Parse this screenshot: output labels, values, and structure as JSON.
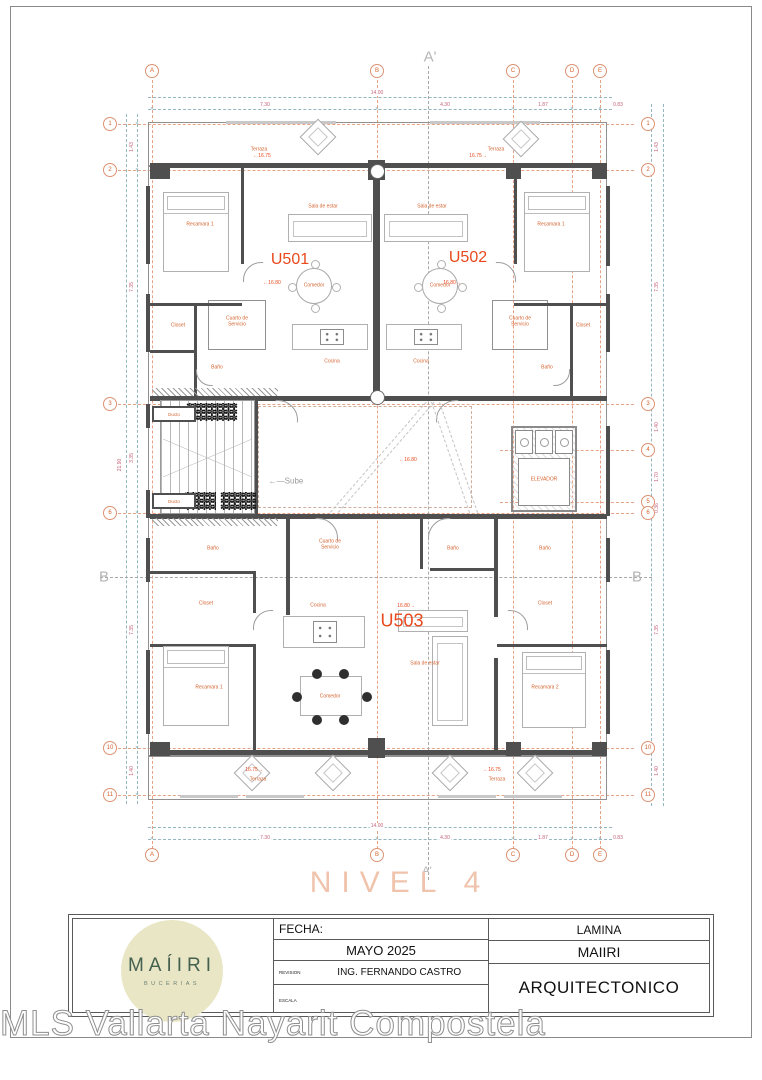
{
  "sheet": {
    "level_title": "NIVEL 4",
    "watermark": "MLS Vallarta Nayarit Compostela"
  },
  "title_block": {
    "logo_name": "MAÍIRI",
    "logo_subtitle": "BUCERIAS",
    "fecha_label": "FECHA:",
    "fecha_value": "MAYO 2025",
    "revision_label": "REVISION",
    "revision_value": "ING. FERNANDO CASTRO",
    "escala_label": "ESCALA",
    "lamina_label": "LAMINA",
    "project_name": "MAIIRI",
    "sheet_name": "ARQUITECTONICO"
  },
  "plan": {
    "grid_cols": [
      {
        "label": "A",
        "x": 152
      },
      {
        "label": "B",
        "x": 377
      },
      {
        "label": "C",
        "x": 513
      },
      {
        "label": "D",
        "x": 572
      },
      {
        "label": "E",
        "x": 600
      }
    ],
    "grid_rows": [
      {
        "label": "1",
        "y": 124,
        "side": "both"
      },
      {
        "label": "2",
        "y": 170,
        "side": "both"
      },
      {
        "label": "3",
        "y": 404,
        "side": "both"
      },
      {
        "label": "4",
        "y": 450,
        "side": "right"
      },
      {
        "label": "5",
        "y": 502,
        "side": "right"
      },
      {
        "label": "6",
        "y": 513,
        "side": "both"
      },
      {
        "label": "10",
        "y": 748,
        "side": "both"
      },
      {
        "label": "11",
        "y": 795,
        "side": "both"
      }
    ],
    "sections": [
      {
        "t": "A'",
        "x": 430,
        "y": 57,
        "s": 15
      },
      {
        "t": "A'",
        "x": 427,
        "y": 871,
        "s": 11
      },
      {
        "t": "B",
        "x": 104,
        "y": 577,
        "s": 15
      },
      {
        "t": "B",
        "x": 637,
        "y": 577,
        "s": 15
      }
    ],
    "slines": [
      {
        "x": 428,
        "y": 66,
        "len": 814,
        "v": 1
      },
      {
        "x": 100,
        "y": 577,
        "len": 552,
        "v": 0
      }
    ],
    "dlines": [
      {
        "x": 148,
        "y": 97,
        "len": 464,
        "v": 0
      },
      {
        "x": 148,
        "y": 109,
        "len": 464,
        "v": 0
      },
      {
        "x": 148,
        "y": 827,
        "len": 464,
        "v": 0
      },
      {
        "x": 148,
        "y": 839,
        "len": 464,
        "v": 0
      },
      {
        "x": 126,
        "y": 114,
        "len": 690,
        "v": 1
      },
      {
        "x": 137,
        "y": 114,
        "len": 690,
        "v": 1
      },
      {
        "x": 651,
        "y": 104,
        "len": 702,
        "v": 1
      },
      {
        "x": 663,
        "y": 104,
        "len": 702,
        "v": 1
      }
    ],
    "dims": [
      {
        "t": "14.00",
        "x": 377,
        "y": 93
      },
      {
        "t": "7.30",
        "x": 265,
        "y": 105
      },
      {
        "t": "4.30",
        "x": 445,
        "y": 105
      },
      {
        "t": "1.87",
        "x": 543,
        "y": 105
      },
      {
        "t": "0.83",
        "x": 618,
        "y": 105
      },
      {
        "t": "14.00",
        "x": 377,
        "y": 826
      },
      {
        "t": "7.30",
        "x": 265,
        "y": 838
      },
      {
        "t": "4.30",
        "x": 445,
        "y": 838
      },
      {
        "t": "1.87",
        "x": 543,
        "y": 838
      },
      {
        "t": "0.83",
        "x": 618,
        "y": 838
      },
      {
        "t": "1.43",
        "x": 132,
        "y": 147,
        "v": 1
      },
      {
        "t": "7.35",
        "x": 132,
        "y": 287,
        "v": 1
      },
      {
        "t": "3.35",
        "x": 132,
        "y": 458,
        "v": 1
      },
      {
        "t": "21.90",
        "x": 120,
        "y": 465,
        "v": 1
      },
      {
        "t": "7.35",
        "x": 132,
        "y": 630,
        "v": 1
      },
      {
        "t": "1.40",
        "x": 132,
        "y": 771,
        "v": 1
      },
      {
        "t": "1.43",
        "x": 657,
        "y": 147,
        "v": 1
      },
      {
        "t": "7.35",
        "x": 657,
        "y": 287,
        "v": 1
      },
      {
        "t": "1.40",
        "x": 657,
        "y": 427,
        "v": 1
      },
      {
        "t": "1.70",
        "x": 657,
        "y": 477,
        "v": 1
      },
      {
        "t": "0.36",
        "x": 657,
        "y": 508,
        "v": 1
      },
      {
        "t": "7.35",
        "x": 657,
        "y": 630,
        "v": 1
      },
      {
        "t": "1.40",
        "x": 657,
        "y": 771,
        "v": 1
      }
    ],
    "walls": [
      [
        150,
        163,
        456,
        5
      ],
      [
        150,
        396,
        457,
        5
      ],
      [
        150,
        514,
        457,
        5
      ],
      [
        150,
        750,
        456,
        5
      ],
      [
        373,
        166,
        7,
        232
      ],
      [
        146,
        186,
        4,
        78
      ],
      [
        146,
        294,
        4,
        58
      ],
      [
        146,
        404,
        4,
        24
      ],
      [
        146,
        490,
        4,
        28
      ],
      [
        146,
        538,
        4,
        44
      ],
      [
        146,
        650,
        4,
        84
      ],
      [
        606,
        186,
        4,
        80
      ],
      [
        606,
        294,
        4,
        58
      ],
      [
        606,
        426,
        4,
        90
      ],
      [
        606,
        538,
        4,
        44
      ],
      [
        606,
        650,
        4,
        84
      ],
      [
        241,
        166,
        3,
        98
      ],
      [
        514,
        166,
        3,
        98
      ],
      [
        150,
        303,
        92,
        3
      ],
      [
        194,
        306,
        3,
        90
      ],
      [
        150,
        350,
        46,
        3
      ],
      [
        514,
        303,
        92,
        3
      ],
      [
        570,
        306,
        3,
        90
      ],
      [
        255,
        398,
        3,
        118
      ],
      [
        286,
        517,
        4,
        98
      ],
      [
        420,
        517,
        3,
        52
      ],
      [
        430,
        568,
        68,
        3
      ],
      [
        494,
        517,
        4,
        100
      ],
      [
        494,
        658,
        4,
        94
      ],
      [
        150,
        571,
        106,
        3
      ],
      [
        150,
        644,
        106,
        3
      ],
      [
        253,
        571,
        3,
        42
      ],
      [
        253,
        646,
        3,
        106
      ],
      [
        497,
        644,
        110,
        3
      ]
    ],
    "boxes": [
      [
        148,
        122,
        459,
        44
      ],
      [
        148,
        166,
        459,
        590
      ],
      [
        148,
        756,
        459,
        44
      ],
      [
        208,
        300,
        58,
        50
      ],
      [
        492,
        300,
        56,
        50
      ]
    ],
    "dashboxes": [
      [
        258,
        406,
        214,
        102
      ]
    ],
    "windows": [
      [
        180,
        795,
        58,
        3
      ],
      [
        246,
        795,
        58,
        3
      ],
      [
        438,
        795,
        58,
        3
      ],
      [
        504,
        795,
        58,
        3
      ],
      [
        226,
        121,
        110,
        3
      ],
      [
        430,
        121,
        110,
        3
      ]
    ],
    "colsq": [
      [
        150,
        163,
        20,
        16
      ],
      [
        368,
        160,
        17,
        20
      ],
      [
        506,
        163,
        15,
        16
      ],
      [
        592,
        163,
        15,
        16
      ],
      [
        150,
        742,
        20,
        14
      ],
      [
        368,
        738,
        17,
        20
      ],
      [
        506,
        742,
        15,
        14
      ],
      [
        592,
        742,
        15,
        14
      ]
    ],
    "colcirc": [
      [
        370,
        164,
        15,
        15
      ],
      [
        370,
        390,
        15,
        15
      ]
    ],
    "furniture": [
      {
        "t": "bed",
        "x": 163,
        "y": 192,
        "w": 66,
        "h": 80
      },
      {
        "t": "bed",
        "x": 524,
        "y": 192,
        "w": 66,
        "h": 80
      },
      {
        "t": "bed",
        "x": 163,
        "y": 646,
        "w": 66,
        "h": 80
      },
      {
        "t": "bed",
        "x": 522,
        "y": 652,
        "w": 64,
        "h": 76
      },
      {
        "t": "sofa",
        "x": 288,
        "y": 214,
        "w": 84,
        "h": 28
      },
      {
        "t": "sofa",
        "x": 384,
        "y": 214,
        "w": 84,
        "h": 28
      },
      {
        "t": "sofa",
        "x": 432,
        "y": 636,
        "w": 36,
        "h": 90
      },
      {
        "t": "sofa",
        "x": 398,
        "y": 610,
        "w": 70,
        "h": 22
      },
      {
        "t": "round",
        "x": 296,
        "y": 268,
        "w": 36,
        "h": 36
      },
      {
        "t": "round",
        "x": 422,
        "y": 268,
        "w": 36,
        "h": 36
      },
      {
        "t": "rtable",
        "x": 300,
        "y": 676,
        "w": 62,
        "h": 40
      },
      {
        "t": "counter",
        "x": 292,
        "y": 324,
        "w": 76,
        "h": 26
      },
      {
        "t": "counter",
        "x": 386,
        "y": 324,
        "w": 76,
        "h": 26
      },
      {
        "t": "counter",
        "x": 283,
        "y": 616,
        "w": 82,
        "h": 32
      },
      {
        "t": "dia",
        "x": 305,
        "y": 124,
        "w": 26,
        "h": 26
      },
      {
        "t": "dia",
        "x": 508,
        "y": 126,
        "w": 26,
        "h": 26
      },
      {
        "t": "dia",
        "x": 239,
        "y": 760,
        "w": 26,
        "h": 26
      },
      {
        "t": "dia",
        "x": 320,
        "y": 760,
        "w": 26,
        "h": 26
      },
      {
        "t": "dia",
        "x": 437,
        "y": 760,
        "w": 26,
        "h": 26
      },
      {
        "t": "dia",
        "x": 522,
        "y": 760,
        "w": 26,
        "h": 26
      },
      {
        "t": "elevator",
        "x": 511,
        "y": 426,
        "w": 66,
        "h": 86
      },
      {
        "t": "stairs",
        "x": 160,
        "y": 400,
        "w": 95,
        "h": 114
      },
      {
        "t": "plant",
        "x": 186,
        "y": 403,
        "w": 66,
        "h": 20
      },
      {
        "t": "plant",
        "x": 184,
        "y": 492,
        "w": 32,
        "h": 20
      },
      {
        "t": "plant",
        "x": 220,
        "y": 492,
        "w": 36,
        "h": 20
      },
      {
        "t": "hatch",
        "x": 152,
        "y": 388,
        "w": 126,
        "h": 8
      },
      {
        "t": "hatch",
        "x": 152,
        "y": 518,
        "w": 126,
        "h": 8
      },
      {
        "t": "ducto",
        "x": 152,
        "y": 406,
        "w": 44,
        "h": 16
      },
      {
        "t": "ducto",
        "x": 152,
        "y": 493,
        "w": 44,
        "h": 16
      }
    ],
    "arcs": [
      {
        "x": 243,
        "y": 262,
        "s": 36,
        "r": 0
      },
      {
        "x": 480,
        "y": 262,
        "s": 36,
        "r": 90
      },
      {
        "x": 196,
        "y": 356,
        "s": 30,
        "r": 270
      },
      {
        "x": 540,
        "y": 356,
        "s": 30,
        "r": 180
      },
      {
        "x": 258,
        "y": 400,
        "s": 40,
        "r": 90
      },
      {
        "x": 436,
        "y": 400,
        "s": 40,
        "r": 0
      },
      {
        "x": 298,
        "y": 518,
        "s": 40,
        "r": 90
      },
      {
        "x": 428,
        "y": 518,
        "s": 40,
        "r": 0
      },
      {
        "x": 253,
        "y": 610,
        "s": 36,
        "r": 0
      },
      {
        "x": 492,
        "y": 610,
        "s": 36,
        "r": 90
      }
    ],
    "rlines": [
      {
        "x": 330,
        "y": 512,
        "len": 146,
        "ang": -49
      },
      {
        "x": 338,
        "y": 512,
        "len": 146,
        "ang": -49
      },
      {
        "x": 432,
        "y": 402,
        "len": 117,
        "ang": 71
      },
      {
        "x": 440,
        "y": 402,
        "len": 117,
        "ang": 71
      }
    ],
    "ducto_label": "Ducto",
    "room_labels": [
      {
        "t": "Terraza",
        "x": 259,
        "y": 150
      },
      {
        "t": "Terraza",
        "x": 496,
        "y": 150
      },
      {
        "t": "Recamara 1",
        "x": 200,
        "y": 225
      },
      {
        "t": "Recamara 1",
        "x": 551,
        "y": 225
      },
      {
        "t": "Sala de estar",
        "x": 323,
        "y": 207
      },
      {
        "t": "Sala de estar",
        "x": 432,
        "y": 207
      },
      {
        "t": "Comedor",
        "x": 314,
        "y": 286
      },
      {
        "t": "Comedor",
        "x": 440,
        "y": 286
      },
      {
        "t": "Cocina",
        "x": 332,
        "y": 362
      },
      {
        "t": "Cocina",
        "x": 421,
        "y": 362
      },
      {
        "t": "Closet",
        "x": 178,
        "y": 326
      },
      {
        "t": "Closet",
        "x": 583,
        "y": 326
      },
      {
        "t": "Cuarto de\nServicio",
        "x": 237,
        "y": 322
      },
      {
        "t": "Cuarto de\nServicio",
        "x": 520,
        "y": 322
      },
      {
        "t": "Baño",
        "x": 217,
        "y": 368
      },
      {
        "t": "Baño",
        "x": 547,
        "y": 368
      },
      {
        "t": "ELEVADOR",
        "x": 544,
        "y": 480
      },
      {
        "t": "Baño",
        "x": 213,
        "y": 549
      },
      {
        "t": "Cuarto de\nServicio",
        "x": 330,
        "y": 545
      },
      {
        "t": "Baño",
        "x": 453,
        "y": 549
      },
      {
        "t": "Baño",
        "x": 545,
        "y": 549
      },
      {
        "t": "Closet",
        "x": 206,
        "y": 604
      },
      {
        "t": "Closet",
        "x": 545,
        "y": 604
      },
      {
        "t": "Cocina",
        "x": 318,
        "y": 606
      },
      {
        "t": "Sala de estar",
        "x": 425,
        "y": 664
      },
      {
        "t": "Comedor",
        "x": 330,
        "y": 697
      },
      {
        "t": "Recamara 1",
        "x": 209,
        "y": 688
      },
      {
        "t": "Recamara 2",
        "x": 545,
        "y": 688
      },
      {
        "t": "Terraza",
        "x": 258,
        "y": 780
      },
      {
        "t": "Terraza",
        "x": 497,
        "y": 780
      }
    ],
    "unit_labels": [
      {
        "t": "U501",
        "x": 290,
        "y": 260,
        "s": 16
      },
      {
        "t": "U502",
        "x": 468,
        "y": 258,
        "s": 16
      },
      {
        "t": "U503",
        "x": 402,
        "y": 621,
        "s": 18
      }
    ],
    "elevations": [
      {
        "t": "16.75",
        "x": 262,
        "y": 156,
        "d": "l"
      },
      {
        "t": "16.75",
        "x": 478,
        "y": 156,
        "d": "r"
      },
      {
        "t": "16.80",
        "x": 272,
        "y": 283,
        "d": "l"
      },
      {
        "t": "16.80",
        "x": 452,
        "y": 283,
        "d": "r"
      },
      {
        "t": "16.80",
        "x": 408,
        "y": 460,
        "d": "l"
      },
      {
        "t": "16.80",
        "x": 406,
        "y": 606,
        "d": "r"
      },
      {
        "t": "16.75",
        "x": 254,
        "y": 770,
        "d": "r"
      },
      {
        "t": "16.75",
        "x": 492,
        "y": 770,
        "d": "l"
      }
    ],
    "stair_label": {
      "t": "Sube",
      "x": 286,
      "y": 481
    }
  }
}
